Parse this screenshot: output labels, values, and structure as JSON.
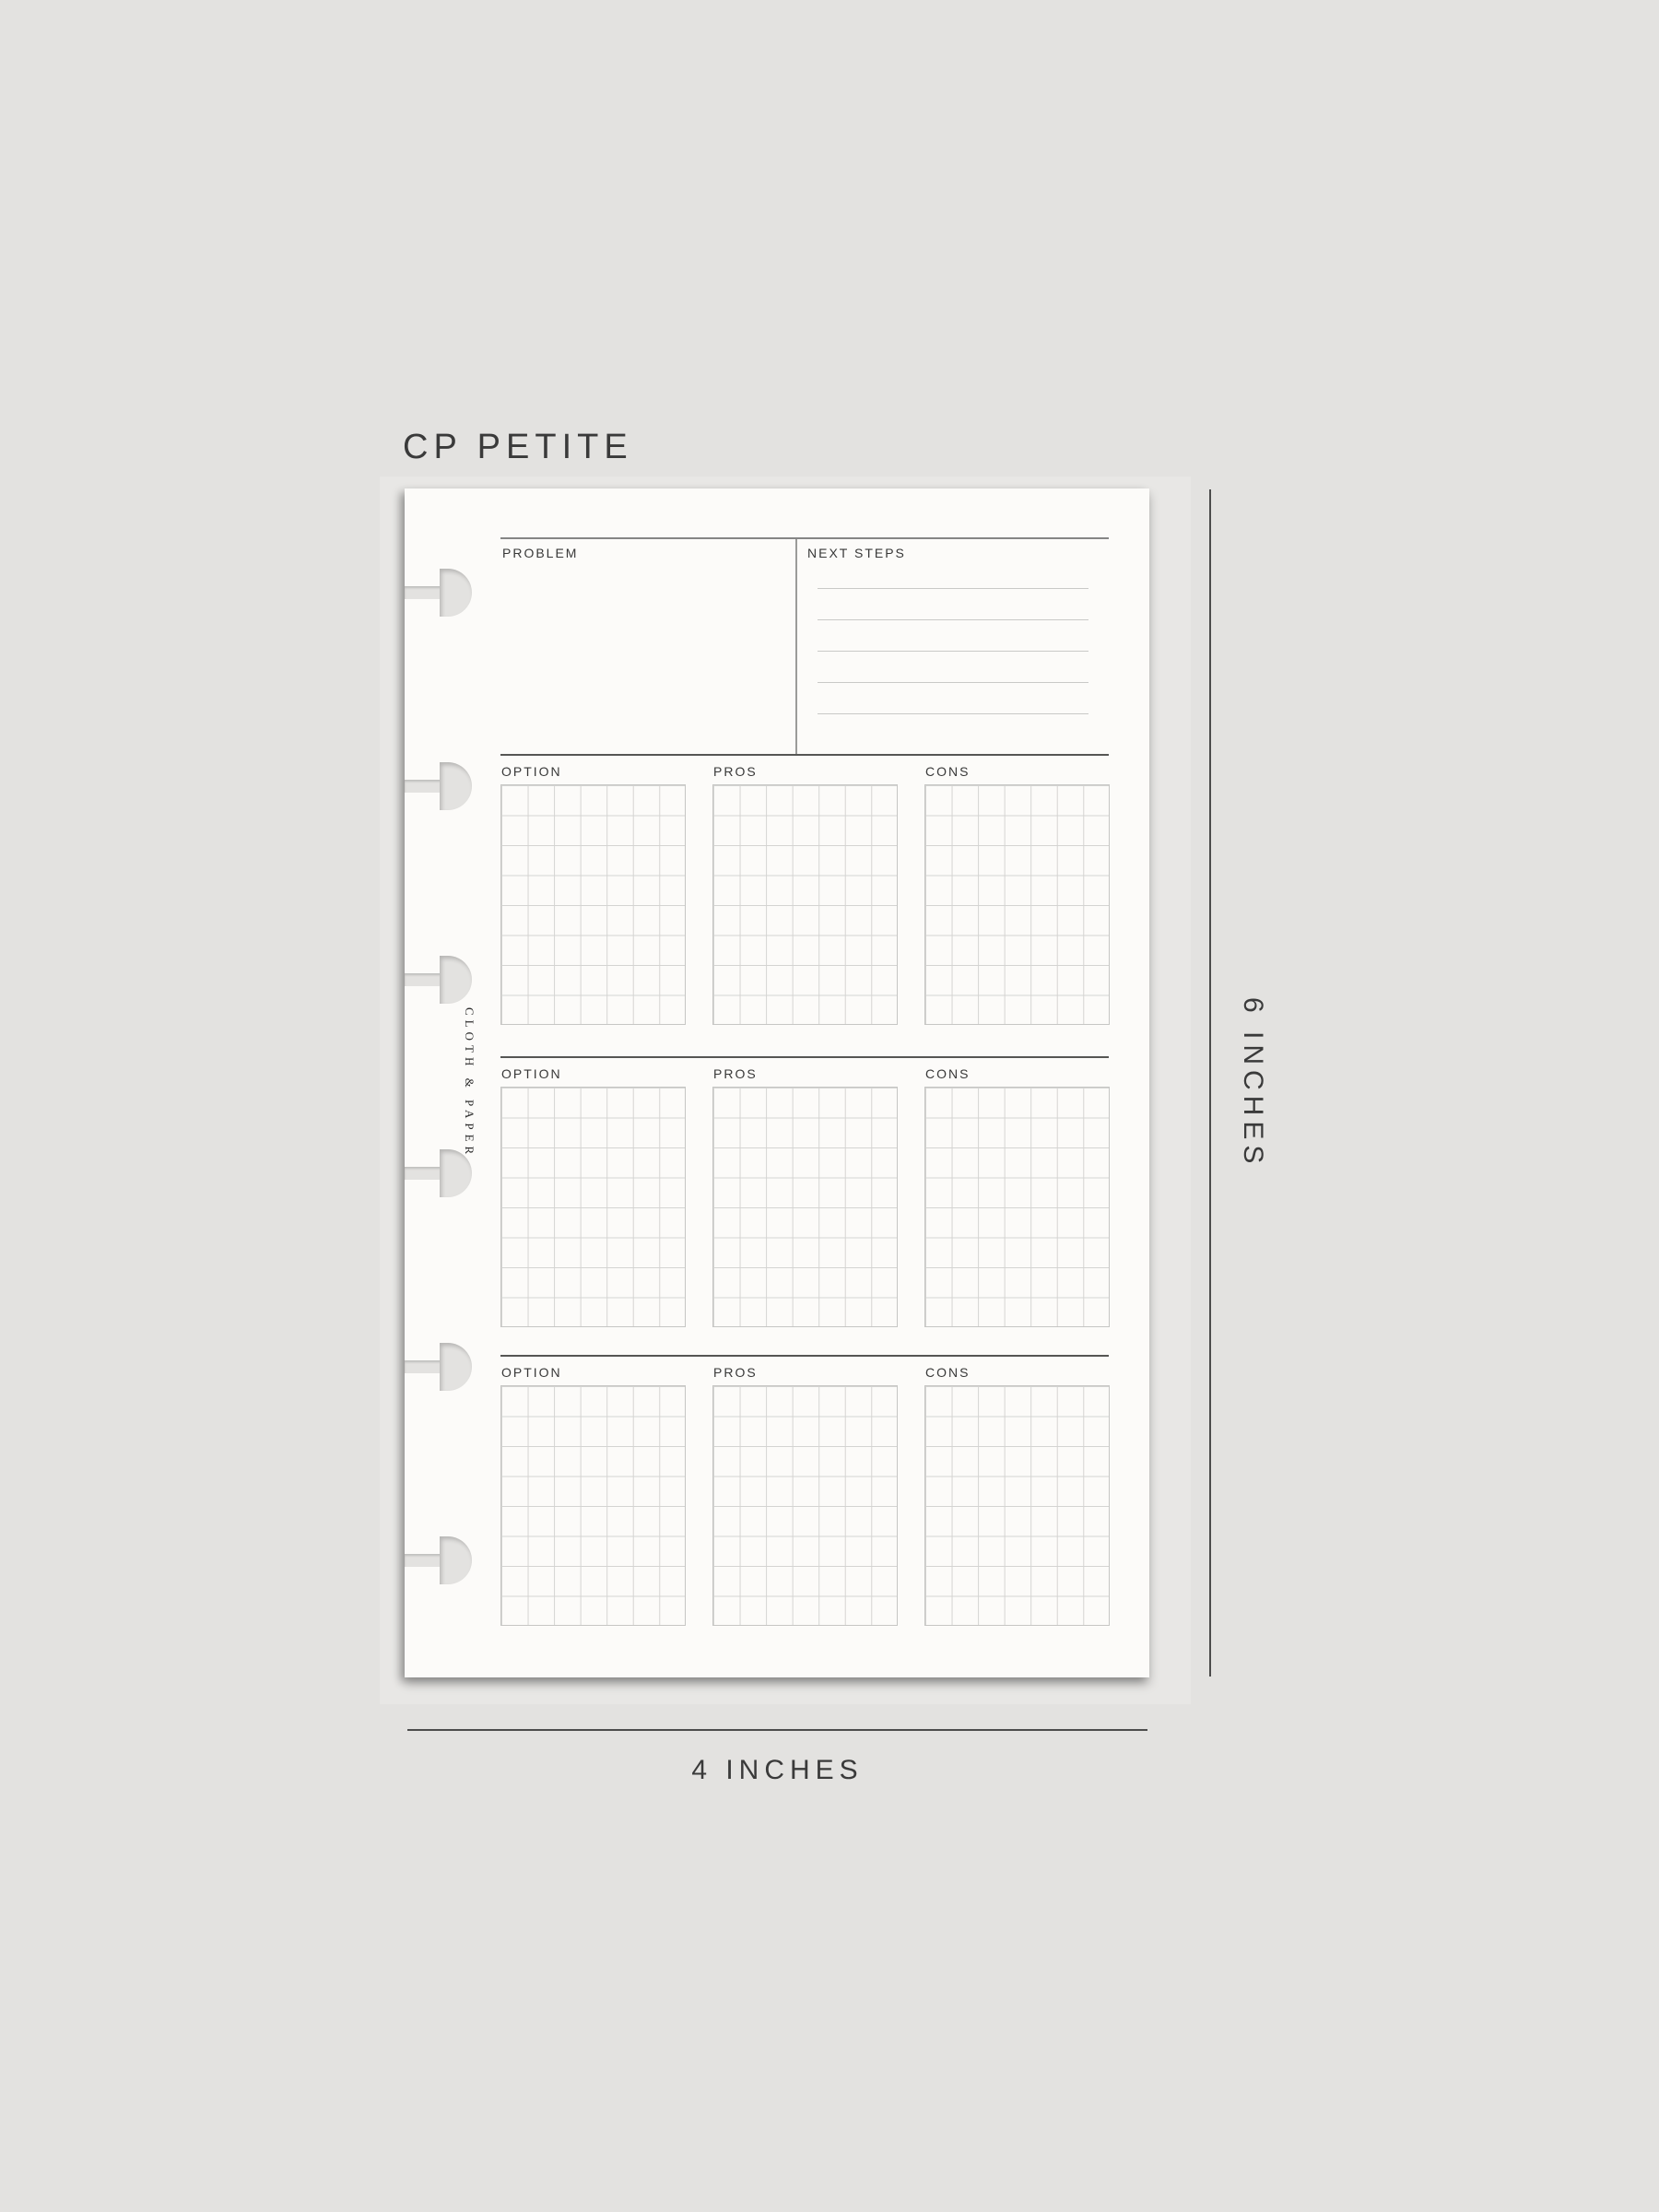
{
  "title": {
    "size_label": "CP PETITE"
  },
  "measurements": {
    "height_label": "6 INCHES",
    "width_label": "4 INCHES"
  },
  "planner_page": {
    "header": {
      "problem_label": "PROBLEM",
      "next_steps_label": "NEXT STEPS"
    },
    "next_steps": {
      "ruled_line_count": 5
    },
    "sections": [
      {
        "option_label": "OPTION",
        "pros_label": "PROS",
        "cons_label": "CONS"
      },
      {
        "option_label": "OPTION",
        "pros_label": "PROS",
        "cons_label": "CONS"
      },
      {
        "option_label": "OPTION",
        "pros_label": "PROS",
        "cons_label": "CONS"
      }
    ],
    "grid": {
      "columns": 7,
      "rows": 8
    },
    "brand_vertical_text": "CLOTH & PAPER",
    "binding_notch_count": 6
  },
  "colors": {
    "background": "#e3e2e0",
    "backdrop_sheet": "#e8e7e5",
    "page": "#fcfbf9",
    "rule_dark": "#565654",
    "rule_gray": "#858585",
    "grid_line": "#d4d4d2",
    "text": "#3a3a3a",
    "measure_line": "#4c4c4c"
  }
}
